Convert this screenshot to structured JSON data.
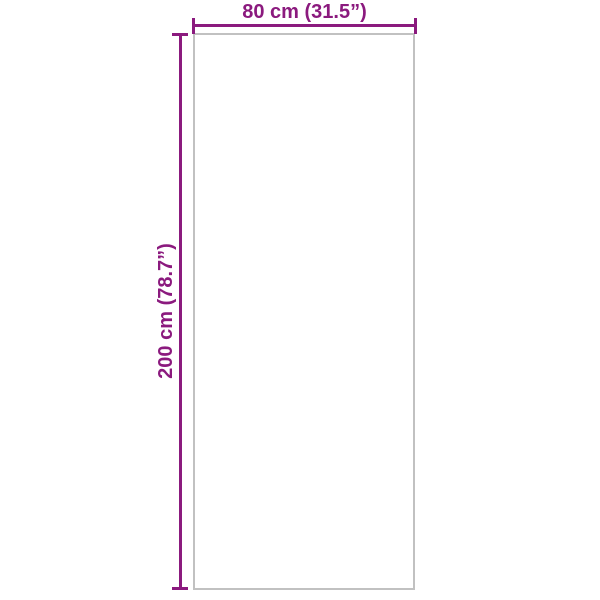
{
  "diagram": {
    "type": "product-dimension-diagram",
    "width_dimension": {
      "label": "80 cm (31.5”)",
      "value_cm": 80,
      "value_inch": 31.5
    },
    "height_dimension": {
      "label": "200 cm (78.7”)",
      "value_cm": 200,
      "value_inch": 78.7
    },
    "colors": {
      "accent": "#8B1A7E",
      "outline": "#C1C1C1",
      "background": "#FFFFFF"
    }
  }
}
